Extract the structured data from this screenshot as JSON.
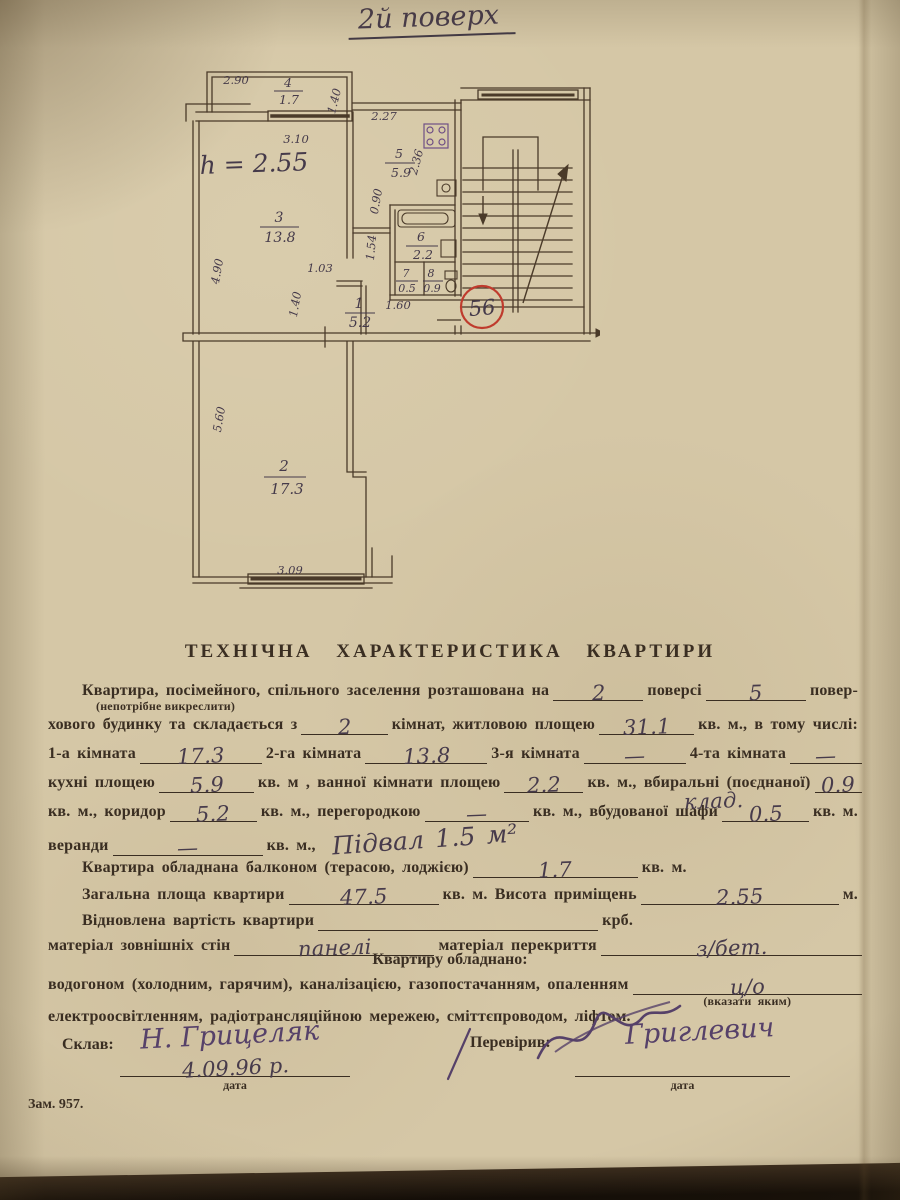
{
  "page": {
    "floor_note": "2й поверх",
    "order_no": "Зам. 957."
  },
  "plan": {
    "apartment_number": "56",
    "height_note": "h = 2.55",
    "rooms": {
      "balcony": {
        "num": "4",
        "area": "1.7"
      },
      "r1": {
        "num": "1",
        "area": "5.2"
      },
      "r2": {
        "num": "2",
        "area": "17.3"
      },
      "r3": {
        "num": "3",
        "area": "13.8"
      },
      "r5": {
        "num": "5",
        "area": "5.9"
      },
      "r6": {
        "num": "6",
        "area": "2.2"
      },
      "r7": {
        "num": "7",
        "area": "0.5"
      },
      "r8": {
        "num": "8",
        "area": "0.9"
      }
    },
    "dims": {
      "d290": "2.90",
      "d140a": "1.40",
      "d310": "3.10",
      "d490": "4.90",
      "d227": "2.27",
      "d236": "2.36",
      "d090": "0.90",
      "d154": "1.54",
      "d103": "1.03",
      "d140b": "1.40",
      "d160": "1.60",
      "d560": "5.60",
      "d309": "3.09"
    }
  },
  "form": {
    "title": "ТЕХНІЧНА  ХАРАКТЕРИСТИКА  КВАРТИРИ",
    "l1a": "Квартира,  посімейного,  спільного  заселення розташована на",
    "l1v1": "2",
    "l1b": "поверсі",
    "l1v2": "5",
    "l1c": "повер-",
    "note1": "(непотрібне викреслити)",
    "l2a": "хового будинку та складається з",
    "l2v1": "2",
    "l2b": "кімнат, житловою площею",
    "l2v2": "31.1",
    "l2c": "кв. м., в тому числі:",
    "l3a": "1-а кімната",
    "l3v1": "17.3",
    "l3b": "2-га кімната",
    "l3v2": "13.8",
    "l3c": "3-я кімната",
    "l3v3": "—",
    "l3d": "4-та кімната",
    "l3v4": "—",
    "l4a": "кухні площею",
    "l4v1": "5.9",
    "l4b": "кв. м , ванної кімнати площею",
    "l4v2": "2.2",
    "l4c": "кв. м., вбиральні (поєднаної)",
    "l4v3": "0.9",
    "l5a": "кв. м., коридор",
    "l5v1": "5.2",
    "l5b": "кв. м., перегородкою",
    "l5v2": "—",
    "l5c": "кв. м., вбудованої шафи",
    "l5note": "клад.",
    "l5v3": "0.5",
    "l5d": "кв. м.",
    "l6a": "веранди",
    "l6v1": "—",
    "l6b": "кв. м.,",
    "l6hand": "Підвал 1.5 м²",
    "l7a": "Квартира обладнана балконом (терасою, лоджією)",
    "l7v1": "1.7",
    "l7b": "кв. м.",
    "l8a": "Загальна площа квартири",
    "l8v1": "47.5",
    "l8b": "кв. м. Висота приміщень",
    "l8v2": "2.55",
    "l8c": "м.",
    "l9a": "Відновлена вартість квартири",
    "l9b": "крб.",
    "l10a": "матеріал зовнішніх стін",
    "l10v1": "панелі",
    "l10b": "матеріал перекриття",
    "l10v2": "з/бет.",
    "l11": "Квартиру обладнано:",
    "l12a": "водогоном  (холодним,  гарячим),  каналізацією,  газопостачанням,  опаленням",
    "l12v1": "ц/о",
    "l12note": "(вказати яким)",
    "l13": "електроосвітленням, радіотрансляційною мережею, сміттєпроводом, ліфтом.",
    "made_label": "Склав:",
    "made_sig": "Н. Грицеляк",
    "made_date": "4.09.96 р.",
    "checked_label": "Перевірив:",
    "checked_sig": "Григлевич",
    "date_label": "дата"
  }
}
